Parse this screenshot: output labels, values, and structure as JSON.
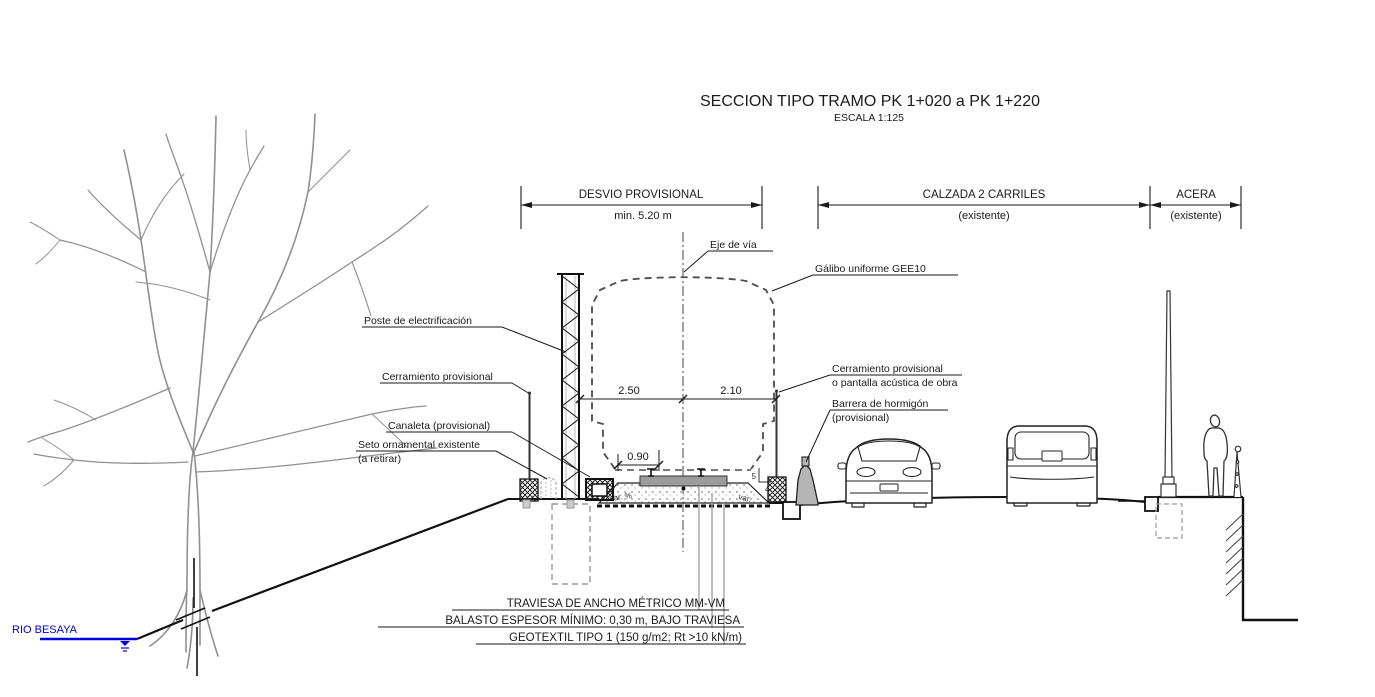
{
  "title": {
    "main": "SECCION TIPO TRAMO PK 1+020 a PK 1+220",
    "scale": "ESCALA 1:125"
  },
  "bands": {
    "desvio": {
      "label": "DESVIO PROVISIONAL",
      "sub": "min. 5.20 m"
    },
    "calzada": {
      "label": "CALZADA 2 CARRILES",
      "sub": "(existente)"
    },
    "acera": {
      "label": "ACERA",
      "sub": "(existente)"
    }
  },
  "labels": {
    "eje_de_via": "Eje de vía",
    "galibo": "Gálibo uniforme GEE10",
    "poste_electrificacion": "Poste de electrificación",
    "cerramiento_izq": "Cerramiento provisional",
    "canaleta": "Canaleta (provisional)",
    "seto": [
      "Seto ornamental existente",
      "(a retirar)"
    ],
    "cerramiento_der": [
      "Cerramiento provisional",
      "o pantalla acústica de obra"
    ],
    "barrera": [
      "Barrera de hormigón",
      "(provisional)"
    ],
    "rio": "RIO BESAYA"
  },
  "dims": {
    "izq": "2.50",
    "der": "2.10",
    "traviesa": "0.90",
    "talud_v": "5",
    "talud_h": "4",
    "var_izq": "var. %",
    "var_der": "var."
  },
  "notes": [
    "TRAVIESA DE ANCHO MÉTRICO MM-VM",
    "BALASTO ESPESOR MÍNIMO: 0,30 m, BAJO TRAVIESA",
    "GEOTEXTIL TIPO 1 (150 g/m2; Rt >10 kN/m)"
  ],
  "colors": {
    "ink": "#1a1a1a",
    "tree_gray": "#909090",
    "leader_gray": "#9a9a9a",
    "river_blue": "#0000dd",
    "concrete_gray": "#b5b5b5",
    "sleeper_gray": "#9c9c9c",
    "dash_gray": "#4d4d4d"
  }
}
